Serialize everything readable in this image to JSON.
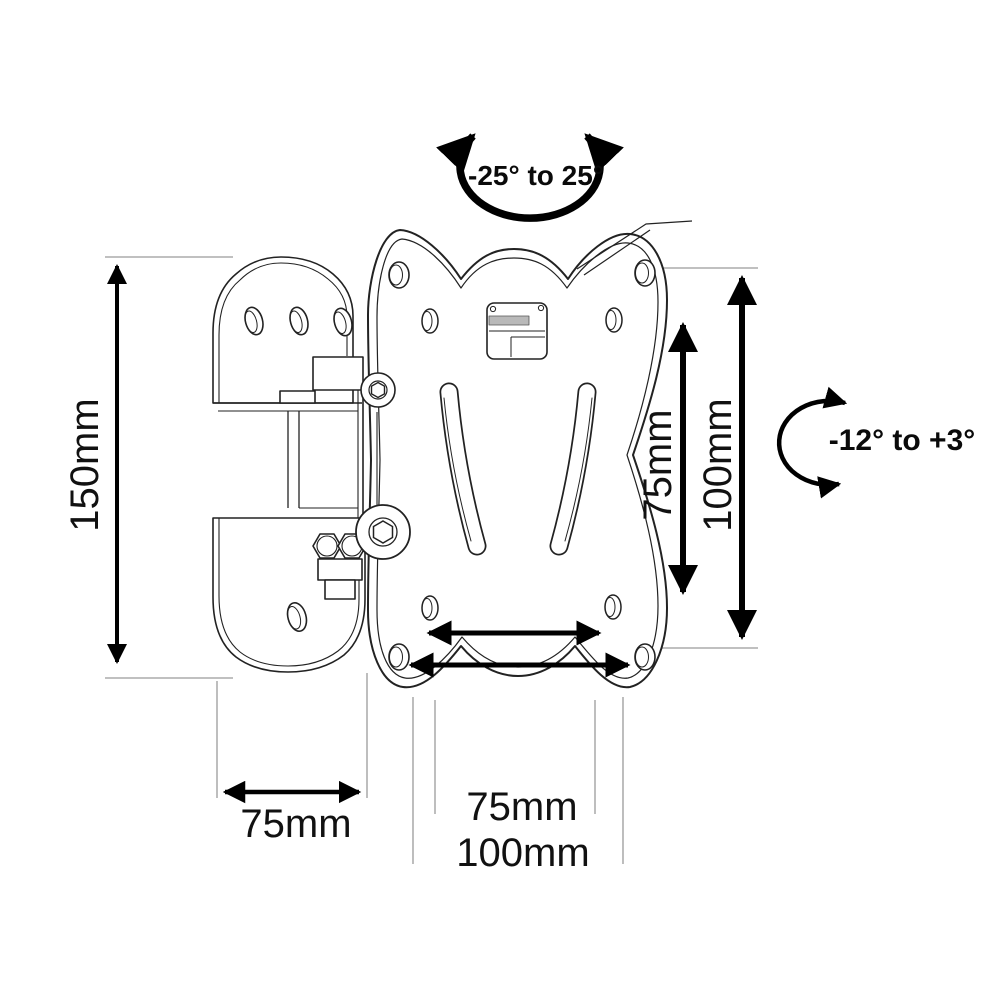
{
  "diagram": {
    "subject": "tv-wall-mount-bracket-technical-drawing",
    "swivel_label": "-25° to 25°",
    "tilt_label": "-12° to +3°",
    "height_label": "150mm",
    "wall_plate_width_label": "75mm",
    "vesa_vertical_inner_label": "75mm",
    "vesa_vertical_outer_label": "100mm",
    "vesa_horizontal_inner_label": "75mm",
    "vesa_horizontal_outer_label": "100mm",
    "colors": {
      "line": "#222222",
      "arrow": "#000000",
      "extension_line": "#9a9a9a",
      "background": "#ffffff",
      "clip_band": "#b9b9b9"
    }
  }
}
